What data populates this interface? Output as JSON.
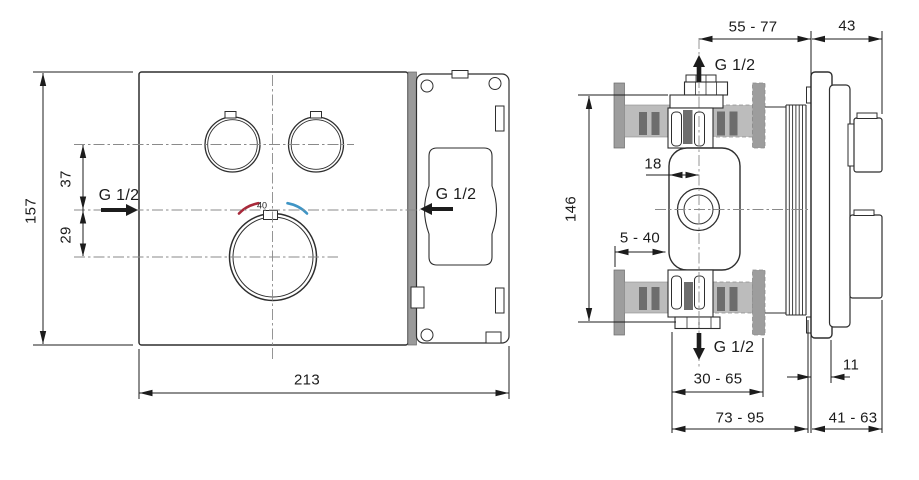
{
  "front_view": {
    "dim_height": "157",
    "dim_handles_to_inlet": "37",
    "dim_inlet_to_dial": "29",
    "dim_width": "213",
    "inlet_label": "G 1/2",
    "outlet_label": "G 1/2",
    "temperature_mark": "40"
  },
  "side_view": {
    "dim_depth_range_top": "55 - 77",
    "dim_trim_projection": "43",
    "top_connection_label": "G 1/2",
    "dim_body_height": "146",
    "dim_center_offset": "18",
    "dim_adjustment_range": "5 - 40",
    "bottom_connection_label": "G 1/2",
    "dim_rough_in_depth": "30 - 65",
    "dim_plate_thickness": "11",
    "dim_overall_depth": "73 - 95",
    "dim_projection_range": "41 - 63"
  },
  "colors": {
    "line": "#2e2e2e",
    "dim": "#1c1c1c",
    "centerline": "#8a8a8a",
    "wall_gray": "#bcbcbc",
    "flange_gray": "#9d9d9d",
    "hatch_dark": "#6d6d6d",
    "band_gray": "#9a9a9a",
    "hot_red": "#a8293a",
    "cold_blue": "#3f95c5"
  }
}
